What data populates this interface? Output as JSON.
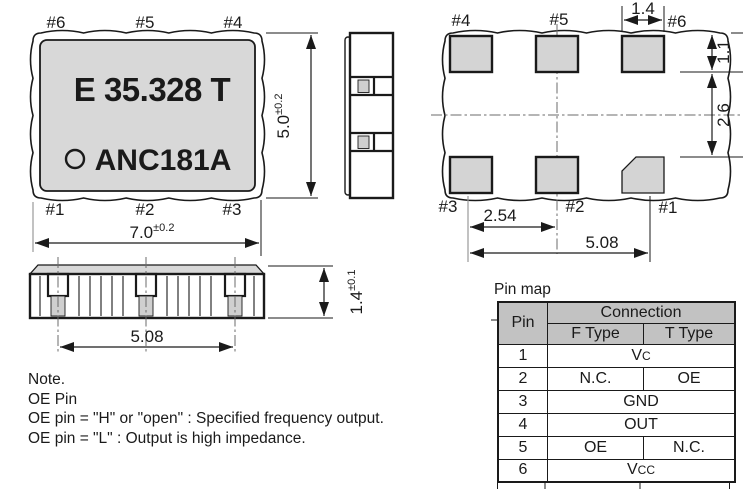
{
  "top_view": {
    "marking_line1": "E 35.328 T",
    "marking_line2": "ANC181A",
    "pins_top": [
      "#6",
      "#5",
      "#4"
    ],
    "pins_bottom": [
      "#1",
      "#2",
      "#3"
    ],
    "dim_width": {
      "value": "7.0",
      "tol": "±0.2"
    },
    "dim_height": {
      "value": "5.0",
      "tol": "±0.2"
    }
  },
  "bottom_view": {
    "pins_top": [
      "#4",
      "#5",
      "#6"
    ],
    "pins_bottom": [
      "#3",
      "#2",
      "#1"
    ],
    "dim_pad_width": "1.4",
    "dim_pad_height": "1.1",
    "dim_row_gap": "2.6",
    "dim_pitch": "2.54",
    "dim_span": "5.08"
  },
  "front_view": {
    "dim_span": "5.08",
    "dim_height": {
      "value": "1.4",
      "tol": "±0.1"
    }
  },
  "note": {
    "line1": "Note.",
    "line2": "OE Pin",
    "line3": "OE pin = \"H\" or \"open\" : Specified frequency output.",
    "line4": "OE pin = \"L\" : Output is high impedance."
  },
  "pin_map": {
    "title": "Pin map",
    "header": {
      "pin": "Pin",
      "connection": "Connection",
      "f_type": "F Type",
      "t_type": "T Type"
    },
    "rows": [
      {
        "pin": "1",
        "base": "V",
        "small": "C"
      },
      {
        "pin": "2",
        "f": "N.C.",
        "t": "OE"
      },
      {
        "pin": "3",
        "conn": "GND"
      },
      {
        "pin": "4",
        "conn": "OUT"
      },
      {
        "pin": "5",
        "f": "OE",
        "t": "N.C."
      },
      {
        "pin": "6",
        "base": "V",
        "small": "CC"
      }
    ]
  },
  "colors": {
    "body_fill": "#d8d8d8",
    "pad_fill": "#d4d4d4",
    "table_header_bg": "#c2c2c2",
    "line": "#1a1a1a"
  }
}
